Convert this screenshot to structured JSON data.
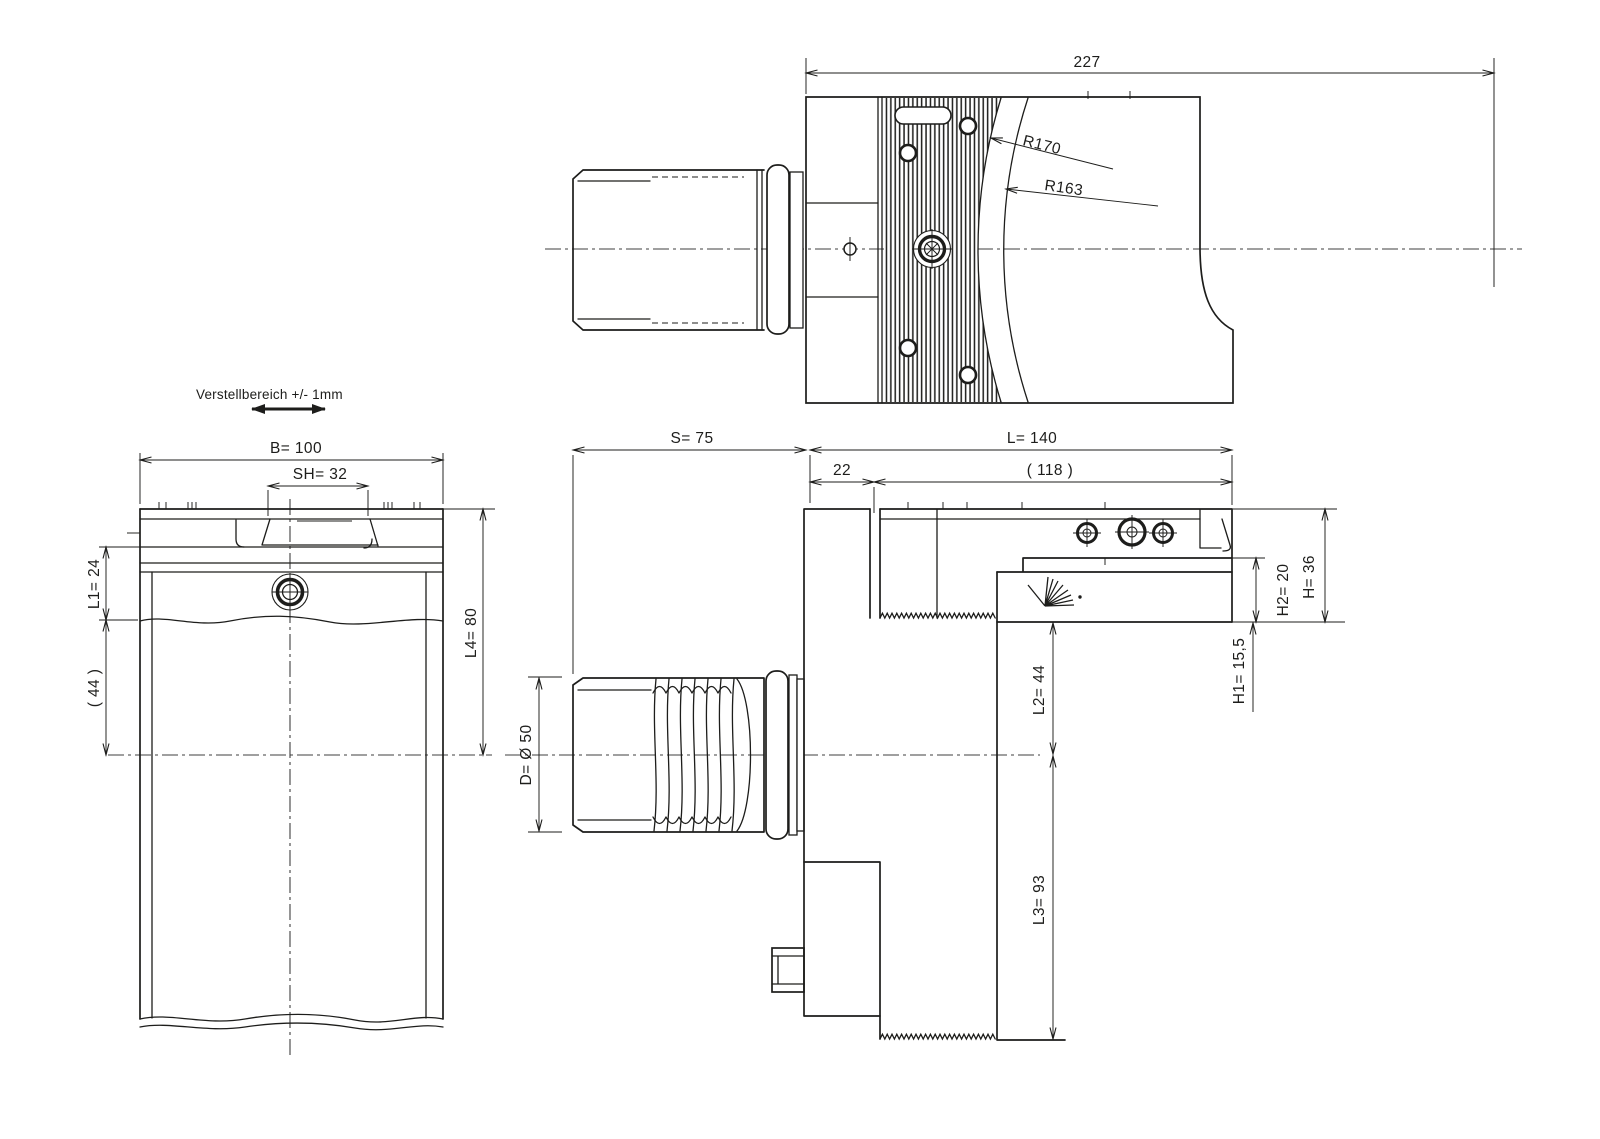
{
  "drawing": {
    "type": "technical-cad-drawing",
    "background": "#ffffff",
    "line_color": "#1d1d1b",
    "top_view": {
      "dim_total_length": "227",
      "radius_outer": "R170",
      "radius_inner": "R163"
    },
    "front_view": {
      "adjust_note": "Verstellbereich +/- 1mm",
      "dim_b": "B= 100",
      "dim_sh": "SH= 32",
      "dim_l1": "L1= 24",
      "dim_44": "( 44 )",
      "dim_l4": "L4= 80"
    },
    "side_view": {
      "dim_s": "S= 75",
      "dim_l": "L= 140",
      "dim_22": "22",
      "dim_118": "( 118 )",
      "dim_d": "D= Ø 50",
      "dim_l2": "L2= 44",
      "dim_l3": "L3= 93",
      "dim_h2": "H2= 20",
      "dim_h": "H= 36",
      "dim_h1": "H1= 15,5"
    }
  }
}
